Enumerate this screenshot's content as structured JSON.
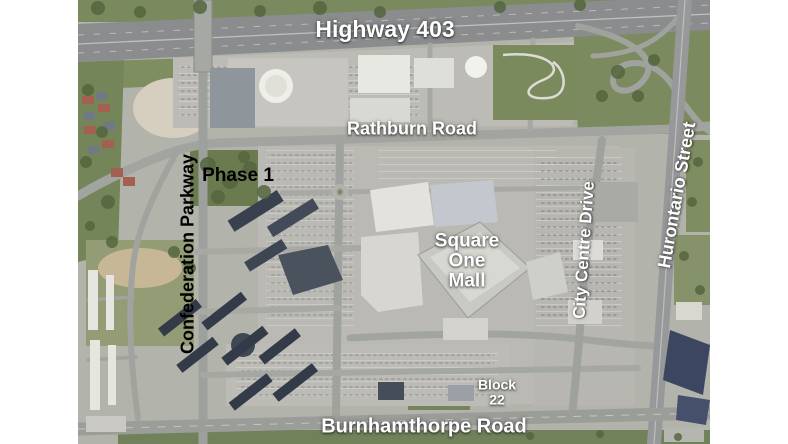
{
  "image_type": "annotated satellite aerial map",
  "labels": {
    "highway_403": "Highway 403",
    "rathburn_road": "Rathburn Road",
    "phase_1": "Phase 1",
    "confederation_parkway": "Confederation Parkway",
    "square_one_mall": "Square\nOne\nMall",
    "city_centre_drive": "City Centre Drive",
    "hurontario_street": "Hurontario Street",
    "block_22": "Block\n22",
    "burnhamthorpe_road": "Burnhamthorpe Road"
  },
  "label_colors": {
    "road_labels": "#ffffff",
    "area_labels": "#000000"
  },
  "map_palette": {
    "margin": "#ffffff",
    "grass": "#7a8a5e",
    "trees": "#55663f",
    "parking": "#b9b8b2",
    "road": "#9a9c9a",
    "highway": "#8b8d8f",
    "building_light": "#e8e7e1",
    "mall_roof": "#ccccc7",
    "dark_roof": "#3a4455",
    "dirt": "#cfc0a4"
  }
}
